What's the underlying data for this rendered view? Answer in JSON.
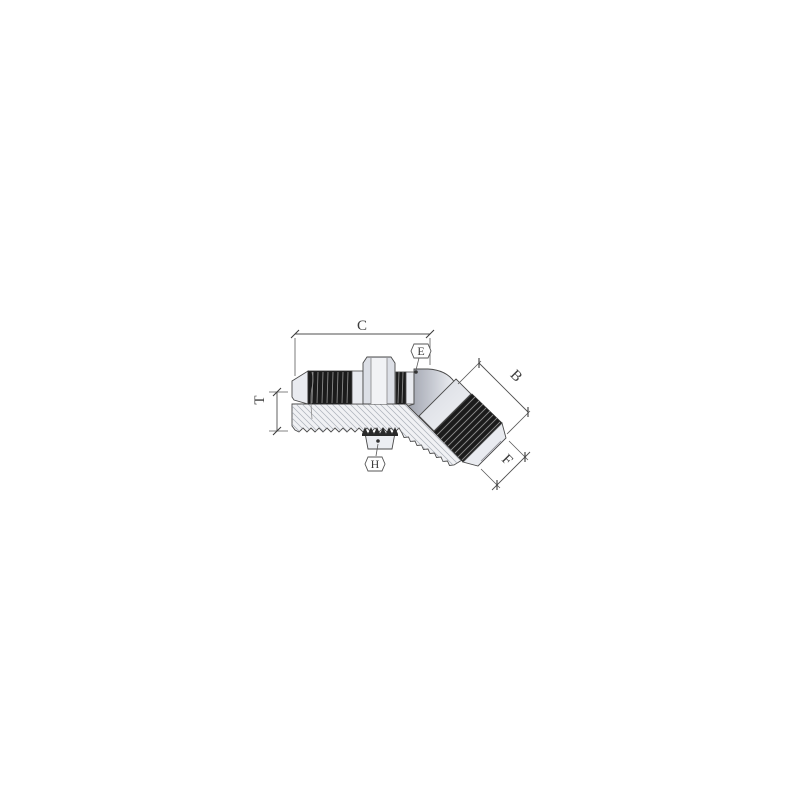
{
  "figure": {
    "kind": "technical-dimension-drawing",
    "subject": "45-degree bulkhead elbow fitting with male flare ends",
    "labels": {
      "c": "C",
      "e": "E",
      "b": "B",
      "t": "T",
      "h": "H",
      "f": "F"
    },
    "colors": {
      "background": "#ffffff",
      "line": "#4a4a4a",
      "dimension": "#4f4f4f",
      "body_fill": "#eceef2",
      "body_fill_light": "#f1f2f5",
      "elbow_shadow": "#9fa3ae",
      "thread_fill": "#1b1b1b",
      "thread_streak": "#8a8a8a",
      "hatch": "#9aa0aa"
    }
  }
}
